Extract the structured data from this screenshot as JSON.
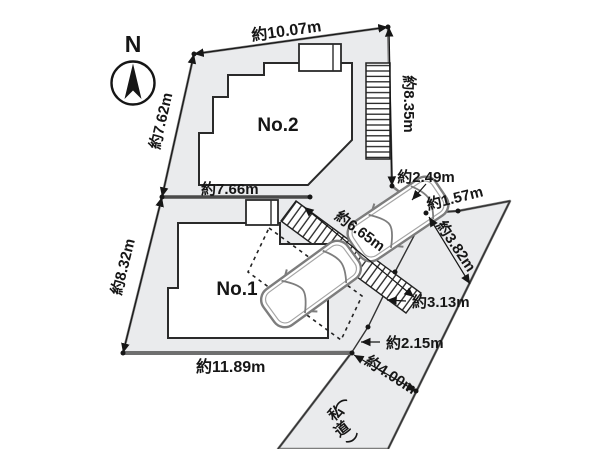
{
  "title": "敷地配置図",
  "compass": {
    "label": "N"
  },
  "buildings": {
    "no1": {
      "label": "No.1"
    },
    "no2": {
      "label": "No.2"
    }
  },
  "dimensions": {
    "top": "約10.07m",
    "left_upper": "約7.62m",
    "right": "約8.35m",
    "division": "約7.66m",
    "left_lower": "約8.32m",
    "bottom": "約11.89m",
    "driveway": "約6.65m",
    "corner_northeast": "約2.49m",
    "road_top": "約1.57m",
    "frontage_upper": "約3.82m",
    "frontage_middle": "約3.13m",
    "frontage_lower": "約2.15m",
    "road_width": "約4.00m"
  },
  "road": {
    "label": "（私道）",
    "label_chars": [
      "（",
      "私",
      "道",
      "）"
    ]
  },
  "colors": {
    "lot_fill": "#eaebed",
    "building_fill": "#ffffff",
    "outline_dark": "#3a3a3a",
    "outline_gray": "#7d7d7d",
    "text": "#161616"
  }
}
